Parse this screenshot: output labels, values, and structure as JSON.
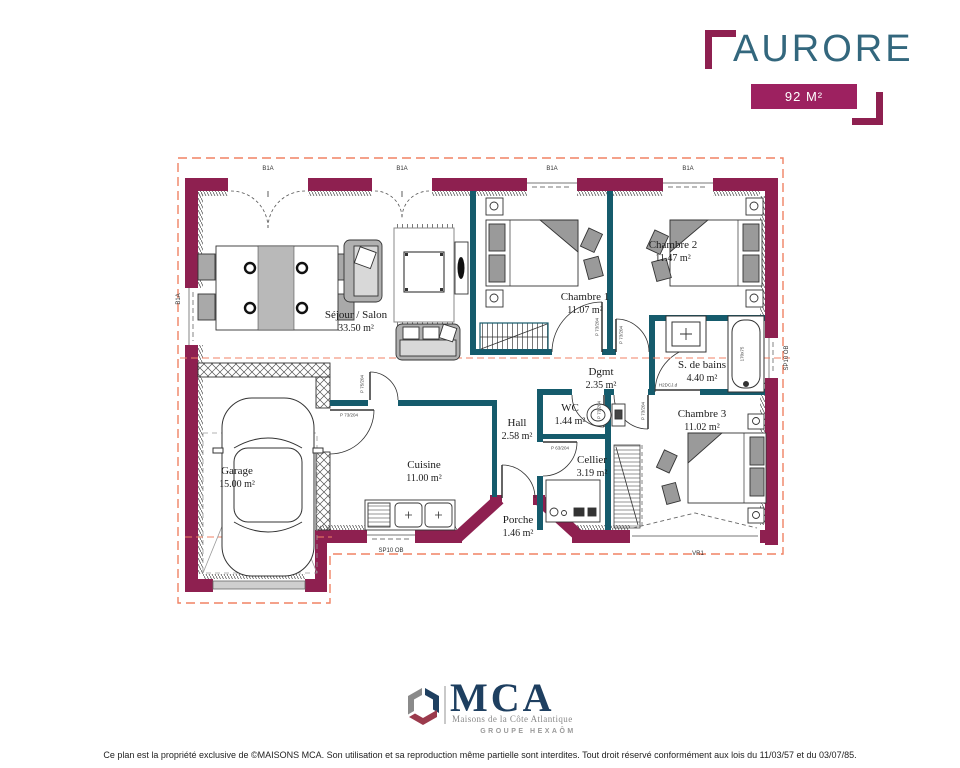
{
  "header": {
    "title": "AURORE",
    "area_badge": "92 M²"
  },
  "rooms": {
    "sejour": {
      "name": "Séjour / Salon",
      "area": "33.50 m²"
    },
    "chambre1": {
      "name": "Chambre 1",
      "area": "11.07 m²"
    },
    "chambre2": {
      "name": "Chambre 2",
      "area": "11.47 m²"
    },
    "chambre3": {
      "name": "Chambre 3",
      "area": "11.02 m²"
    },
    "sdb": {
      "name": "S. de bains",
      "area": "4.40 m²"
    },
    "dgmt": {
      "name": "Dgmt",
      "area": "2.35 m²"
    },
    "wc": {
      "name": "WC",
      "area": "1.44 m²"
    },
    "hall": {
      "name": "Hall",
      "area": "2.58 m²"
    },
    "cuisine": {
      "name": "Cuisine",
      "area": "11.00 m²"
    },
    "cellier": {
      "name": "Cellier",
      "area": "3.19 m²"
    },
    "porche": {
      "name": "Porche",
      "area": "1.46 m²"
    },
    "garage": {
      "name": "Garage",
      "area": "15.00 m²"
    }
  },
  "openings": {
    "bay_label": "B1A",
    "sliding_label": "SP10 OB",
    "roller_label": "VR1",
    "door_73": "P 73/204",
    "door_75": "P 75/204",
    "door_63": "P 63/204",
    "bath_door": "H2DCJ.d",
    "bathtub_size": "170x75"
  },
  "logo": {
    "acronym": "MCA",
    "tagline": "Maisons de la Côte Atlantique",
    "group": "GROUPE HEXAÔM"
  },
  "footer": {
    "copyright": "Ce plan est la propriété exclusive de ©MAISONS MCA. Son utilisation et sa reproduction même partielle sont interdites. Tout droit réservé conformément aux lois du 11/03/57 et du 03/07/85."
  },
  "colors": {
    "exterior_wall": "#8E2050",
    "partition_wall": "#155B6C",
    "outline_dashed": "#F08264",
    "title_text": "#33677D",
    "badge_bg": "#9D2160",
    "logo_navy": "#1E3F60"
  }
}
